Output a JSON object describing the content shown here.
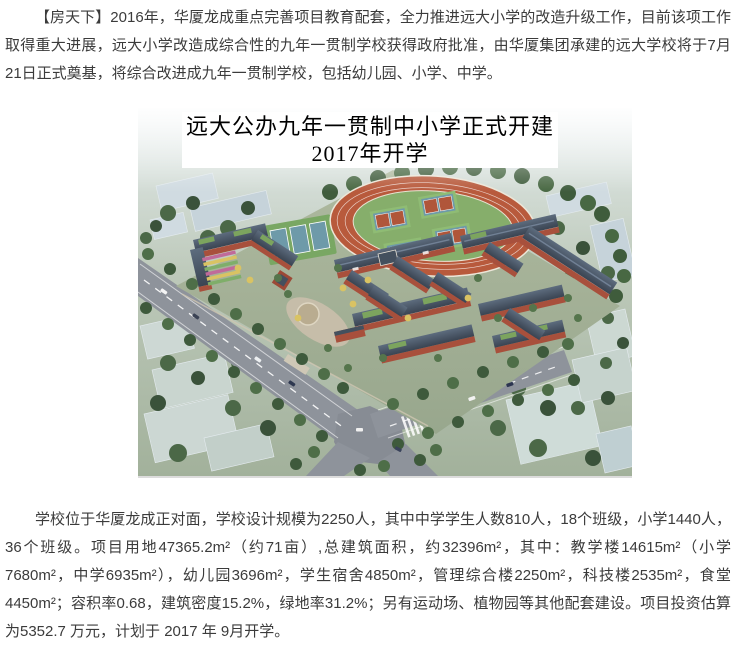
{
  "article": {
    "paragraph_intro": "【房天下】2016年，华厦龙成重点完善项目教育配套，全力推进远大小学的改造升级工作，目前该项工作取得重大进展，远大小学改造成综合性的九年一贯制学校获得政府批准，由华厦集团承建的远大学校将于7月21日正式奠基，将综合改进成九年一贯制学校，包括幼儿园、小学、中学。",
    "paragraph_details": "学校位于华厦龙成正对面，学校设计规模为2250人，其中中学学生人数810人，18个班级，小学1440人，36个班级。项目用地47365.2m²（约71亩）,总建筑面积，约32396m²，其中：教学楼14615m²（小学7680m²，中学6935m²），幼儿园3696m²，学生宿舍4850m²，管理综合楼2250m²，科技楼2535m²，食堂4450m²；容积率0.68，建筑密度15.2%，绿地率31.2%；另有运动场、植物园等其他配套建设。项目投资估算为5352.7 万元，计划于 2017 年 9月开学。"
  },
  "hero_image": {
    "title_line1": "远大公办九年一贯制中小学正式开建",
    "title_line2": "2017年开学",
    "colors": {
      "track": "#b85a3c",
      "infield": "#86ae6b",
      "brick_wall": "#a8503c",
      "slate_roof": "#3f4a58",
      "green_roof": "#7ca45e",
      "court_deck": "#6e9aa9",
      "road": "#8e939b",
      "surrounding_block": "#d0dbe1"
    }
  },
  "text_colors": {
    "body": "#3b3b3b",
    "image_title": "#000000"
  }
}
